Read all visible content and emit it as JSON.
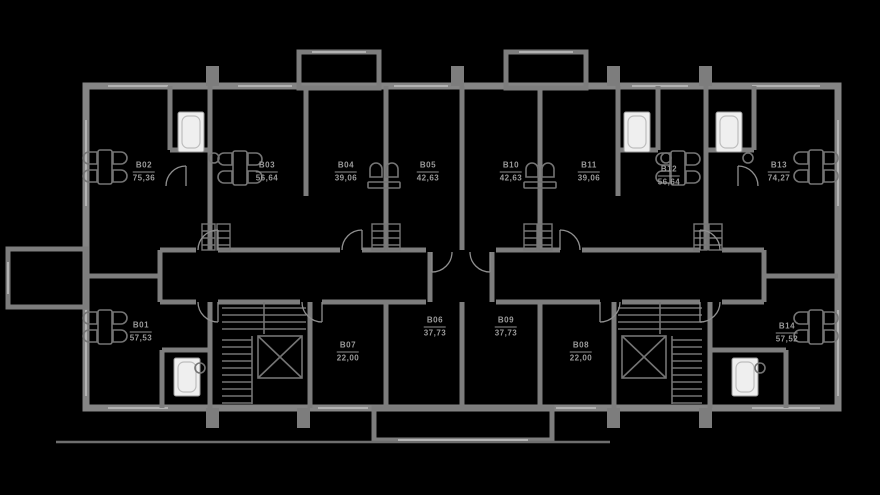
{
  "plan": {
    "units": [
      {
        "id": "B01",
        "area": "57,53"
      },
      {
        "id": "B02",
        "area": "75,36"
      },
      {
        "id": "B03",
        "area": "56,64"
      },
      {
        "id": "B04",
        "area": "39,06"
      },
      {
        "id": "B05",
        "area": "42,63"
      },
      {
        "id": "B06",
        "area": "37,73"
      },
      {
        "id": "B07",
        "area": "22,00"
      },
      {
        "id": "B08",
        "area": "22,00"
      },
      {
        "id": "B09",
        "area": "37,73"
      },
      {
        "id": "B10",
        "area": "42,63"
      },
      {
        "id": "B11",
        "area": "39,06"
      },
      {
        "id": "B12",
        "area": "56,64"
      },
      {
        "id": "B13",
        "area": "74,27"
      },
      {
        "id": "B14",
        "area": "57,52"
      }
    ],
    "colors": {
      "background": "#000000",
      "walls": "#7d7d7d",
      "fixtures": "#747474",
      "label_text": "#9a9a9a",
      "bathtub_fill": "#efefef"
    },
    "icons": [
      "dining-set-icon",
      "chair-icon",
      "bathtub-icon",
      "sink-icon",
      "stairs-icon",
      "elevator-icon",
      "door-arc-icon",
      "riser-shaft-icon"
    ]
  }
}
